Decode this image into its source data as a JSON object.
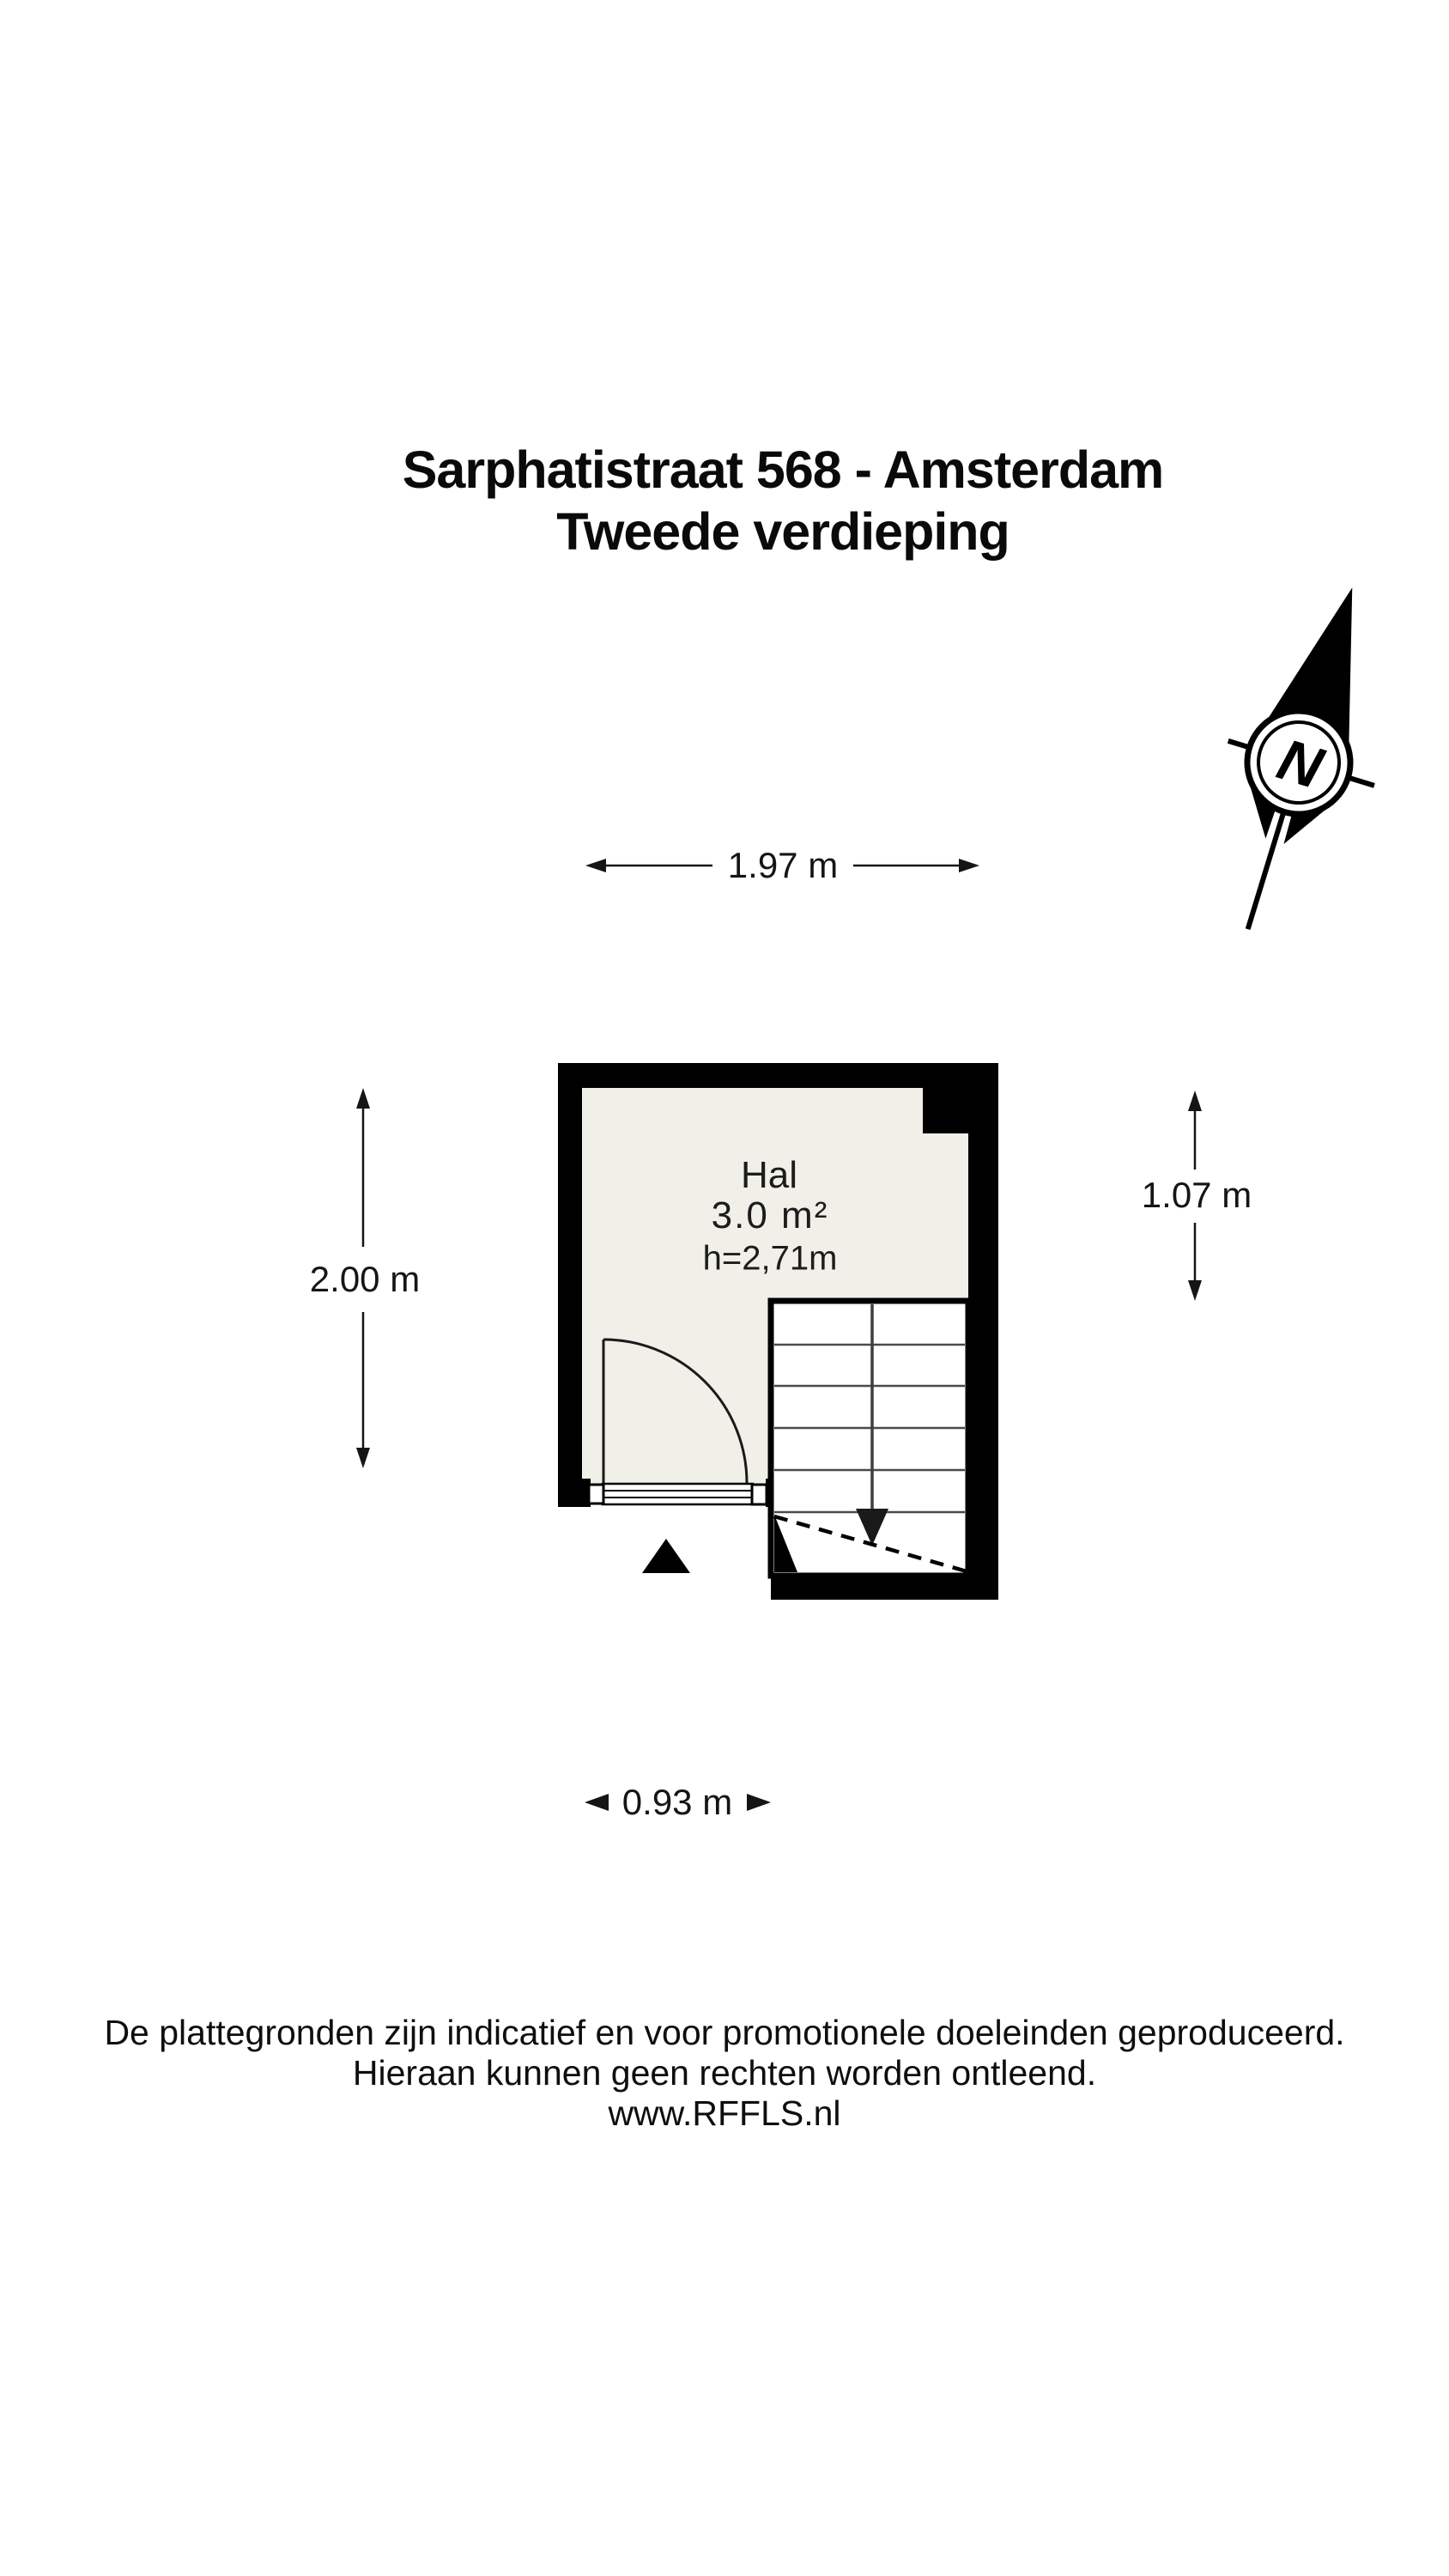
{
  "title": {
    "line1": "Sarphatistraat 568 - Amsterdam",
    "line2": "Tweede verdieping"
  },
  "compass": {
    "label": "N"
  },
  "room": {
    "name": "Hal",
    "area": "3.0 m²",
    "height": "h=2,71m"
  },
  "dimensions": {
    "top": "1.97 m",
    "left": "2.00 m",
    "right": "1.07 m",
    "bottom": "0.93 m"
  },
  "footer": {
    "line1": "De plattegronden zijn indicatief en voor promotionele doeleinden geproduceerd.",
    "line2": "Hieraan kunnen geen rechten worden ontleend.",
    "line3": "www.RFFLS.nl"
  },
  "colors": {
    "wall": "#000000",
    "floor": "#f0efe8",
    "stair_tread": "#4a4a4a",
    "dimension_line": "#111111",
    "background": "#ffffff"
  }
}
